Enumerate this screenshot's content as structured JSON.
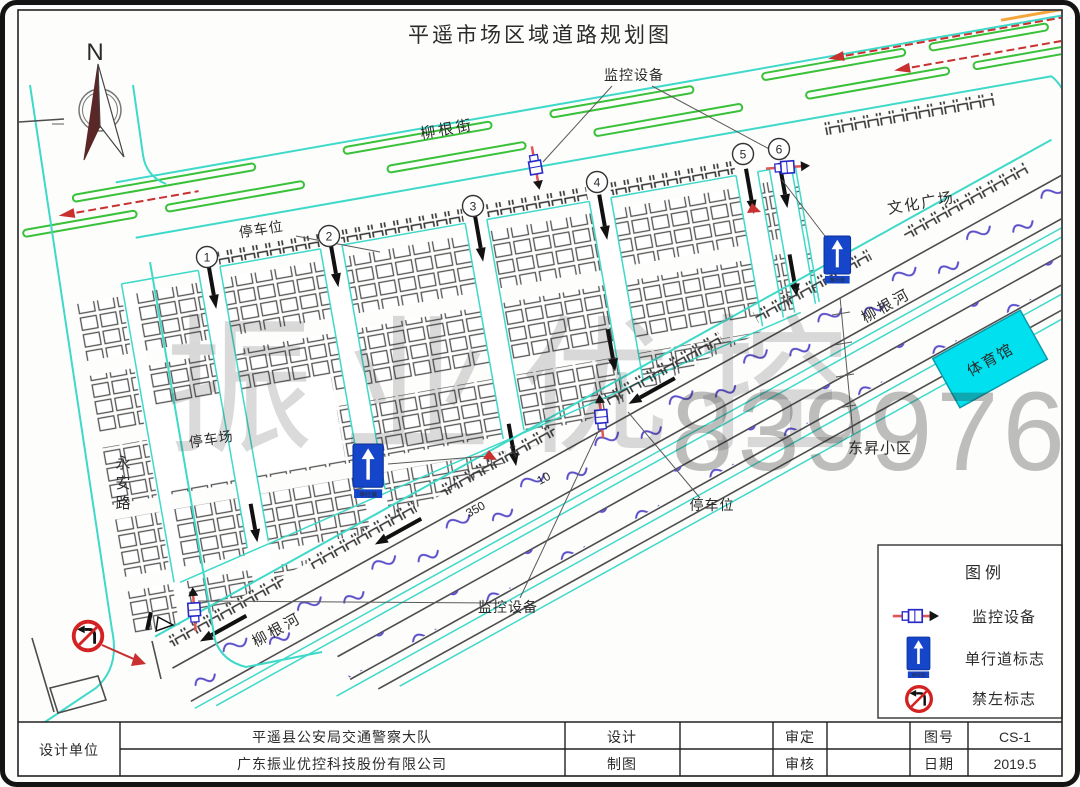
{
  "title": "平遥市场区域道路规划图",
  "compass": {
    "north_label": "N"
  },
  "map": {
    "streets": {
      "liugen_street": "柳根街",
      "yongan_road": "永安路",
      "liugen_river_upper": "柳根河",
      "liugen_river_lower": "柳根河"
    },
    "areas": {
      "culture_plaza": "文化广场",
      "gymnasium": "体育馆",
      "dongsheng_block": "东昇小区",
      "parking_lot": "停车场"
    },
    "labels": {
      "parking_spot_top": "停车位",
      "parking_spot_bottom": "停车位",
      "monitor_top": "监控设备",
      "monitor_bottom": "监控设备"
    },
    "dimensions": {
      "d350": "350",
      "d10": "10"
    },
    "lane_numbers": [
      "1",
      "2",
      "3",
      "4",
      "5",
      "6"
    ],
    "oneway_sign_text": "单行道"
  },
  "legend": {
    "title": "图例",
    "items": [
      {
        "icon": "camera",
        "label": "监控设备"
      },
      {
        "icon": "one-way",
        "label": "单行道标志"
      },
      {
        "icon": "no-left-turn",
        "label": "禁左标志"
      }
    ]
  },
  "watermark": {
    "text": "振业优控",
    "digits": "839976"
  },
  "title_block": {
    "design_unit_label": "设计单位",
    "design_org": "平遥县公安局交通警察大队",
    "drawing_company": "广东振业优控科技股份有限公司",
    "design_label": "设计",
    "draft_label": "制图",
    "approve_label": "审定",
    "review_label": "审核",
    "drawing_no_label": "图号",
    "drawing_no": "CS-1",
    "date_label": "日期",
    "date": "2019.5"
  },
  "colors": {
    "road_cyan": "#3fd9c9",
    "lane_green": "#39c139",
    "flow_red": "#c93030",
    "sign_blue": "#1545c8",
    "water_purple": "#5b4fc8",
    "gym_fill": "#00e0ee"
  }
}
